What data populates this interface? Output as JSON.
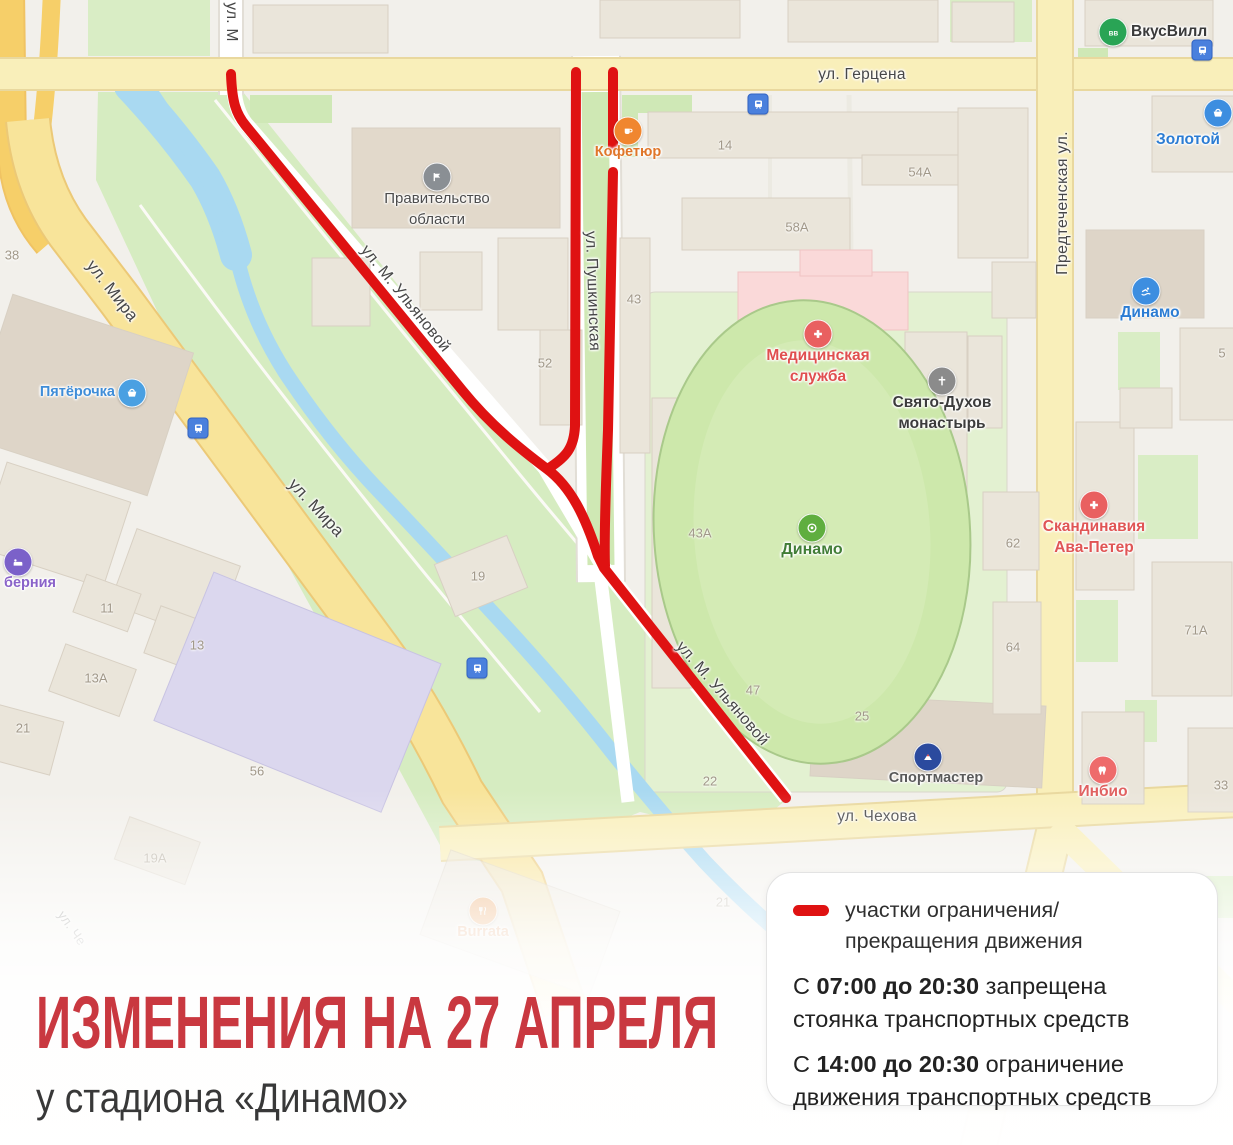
{
  "title": {
    "heading": "ИЗМЕНЕНИЯ НА 27 АПРЕЛЯ",
    "subheading": "у стадиона «Динамо»"
  },
  "legend": {
    "item1": "участки ограничения/прекращения движения",
    "item2_prefix": "С ",
    "item2_bold": "07:00 до 20:30",
    "item2_rest": " запрещена стоянка транспортных средств",
    "item3_prefix": "С ",
    "item3_bold": "14:00 до 20:30",
    "item3_rest": " ограничение движения транспортных средств"
  },
  "colors": {
    "restriction_red": "#df1212",
    "title_red": "#c93840",
    "road_yellow": "#f8eba8",
    "highway_orange": "#f6cf69",
    "park_green": "#d6ecc1",
    "water_blue": "#a9d9f1",
    "building_beige": "#eae5da"
  },
  "icons": {
    "transit-stop": "blue rounded square with tram",
    "restricted-line": "thick red rounded line"
  },
  "map": {
    "street_labels": [
      {
        "label": "ул. Герцена"
      },
      {
        "label": "ул. М"
      },
      {
        "label": "ул. Мира"
      },
      {
        "label": "ул. Мира"
      },
      {
        "label": "ул. М. Ульяновой"
      },
      {
        "label": "ул. М. Ульяновой"
      },
      {
        "label": "ул. Пушкинская"
      },
      {
        "label": "Предтеченская ул."
      },
      {
        "label": "ул. Чехова"
      },
      {
        "label": "ул. Че"
      }
    ],
    "house_numbers": [
      {
        "label": "38"
      },
      {
        "label": "14"
      },
      {
        "label": "54А"
      },
      {
        "label": "58А"
      },
      {
        "label": "43"
      },
      {
        "label": "5"
      },
      {
        "label": "52"
      },
      {
        "label": "62"
      },
      {
        "label": "43А"
      },
      {
        "label": "19"
      },
      {
        "label": "11"
      },
      {
        "label": "71А"
      },
      {
        "label": "64"
      },
      {
        "label": "13"
      },
      {
        "label": "13А"
      },
      {
        "label": "47"
      },
      {
        "label": "25"
      },
      {
        "label": "21"
      },
      {
        "label": "22"
      },
      {
        "label": "33"
      },
      {
        "label": "56"
      },
      {
        "label": "19А"
      },
      {
        "label": "21"
      }
    ],
    "pois": [
      {
        "label": "Пятёрочка"
      },
      {
        "label": "берния"
      },
      {
        "label": "ВкусВилл"
      },
      {
        "label": "Золотой"
      },
      {
        "label": "Кофетюр"
      },
      {
        "label": "Правительство",
        "label2": "области"
      },
      {
        "label": "Медицинская",
        "label2": "служба"
      },
      {
        "label": "Свято-Духов",
        "label2": "монастырь"
      },
      {
        "label": "Динамо"
      },
      {
        "label": "Динамо"
      },
      {
        "label": "Скандинавия",
        "label2": "Ава-Петер"
      },
      {
        "label": "Спортмастер"
      },
      {
        "label": "Инбио"
      },
      {
        "label": "Burrata"
      }
    ]
  }
}
